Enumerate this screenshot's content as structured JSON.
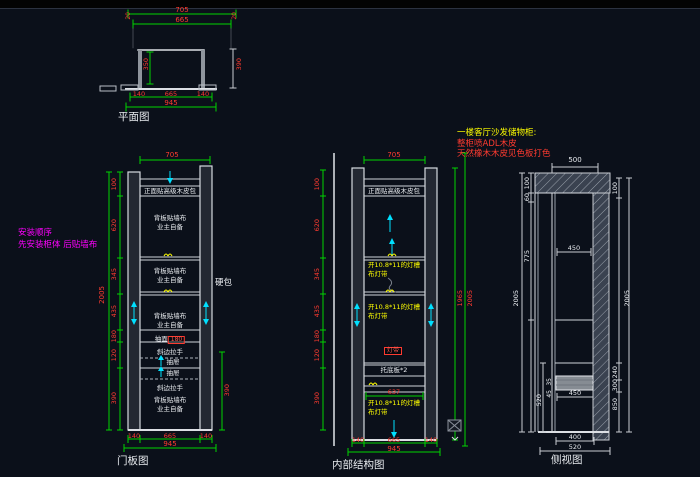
{
  "notes": {
    "install_title": "安装顺序",
    "install_line": "先安装柜体 后贴墙布",
    "spec_title": "一楼客厅沙发储物柜:",
    "spec_line1": "整柜喷ADL木皮",
    "spec_line2": "天然橡木木皮见色板打色"
  },
  "plan": {
    "title": "平面图",
    "dim_top1": "705",
    "dim_top2": "665",
    "dim_top_left": "20",
    "dim_top_right": "20",
    "dim_inner": "350",
    "dim_right": "390",
    "dim_bottom_left": "140",
    "dim_bottom_mid": "665",
    "dim_bottom_right": "140",
    "dim_bottom_total": "945"
  },
  "door": {
    "title": "门板图",
    "dim_top": "705",
    "left_total": "2005",
    "left_dims": [
      "100",
      "620",
      "345",
      "435",
      "180",
      "120",
      "390"
    ],
    "right_dim": "390",
    "bottom_dims": [
      "140",
      "665",
      "140"
    ],
    "bottom_total": "945",
    "top_note": "正面贴高级木皮包",
    "back_note1": "背板贴墙布",
    "back_note2": "业主自备",
    "drawer_face_label": "抽面",
    "drawer_face_value": "180",
    "handle": "斜边拉手",
    "drawer": "抽屉",
    "hard_pack": "硬包"
  },
  "internal": {
    "title": "内部结构图",
    "dim_top": "705",
    "left_dims": [
      "100",
      "620",
      "345",
      "435",
      "180",
      "120",
      "390"
    ],
    "right_dim_inner": "1965",
    "right_dim_outer": "2005",
    "bottom_dims": [
      "140",
      "665",
      "140"
    ],
    "bottom_total": "945",
    "top_note": "正面贴高级木皮包",
    "light_note1": "开10.8*11的灯槽",
    "light_note2": "布灯带",
    "light_tag": "灯带",
    "support_note": "托底板*2",
    "dim_inner": "637"
  },
  "side": {
    "title": "侧视图",
    "dim_top": "500",
    "left_outer_total": "2005",
    "left_dims": [
      "100",
      "60",
      "775"
    ],
    "left_mid": "520",
    "left_small1": "35",
    "left_small2": "45",
    "inner_depth": "450",
    "drawer_depth": "450",
    "right_dims": [
      "100",
      "240",
      "300",
      "850"
    ],
    "right_total": "2005",
    "bottom_dim1": "400",
    "bottom_dim2": "520"
  },
  "colors": {
    "background": "#0b101a",
    "geometry": "#d9dde3",
    "dimension_line": "#00d400",
    "dimension_text": "#ff3b30",
    "annotation": "#ffff00",
    "grain_arrow": "#00e0ff",
    "install_note": "#ff00ff"
  }
}
